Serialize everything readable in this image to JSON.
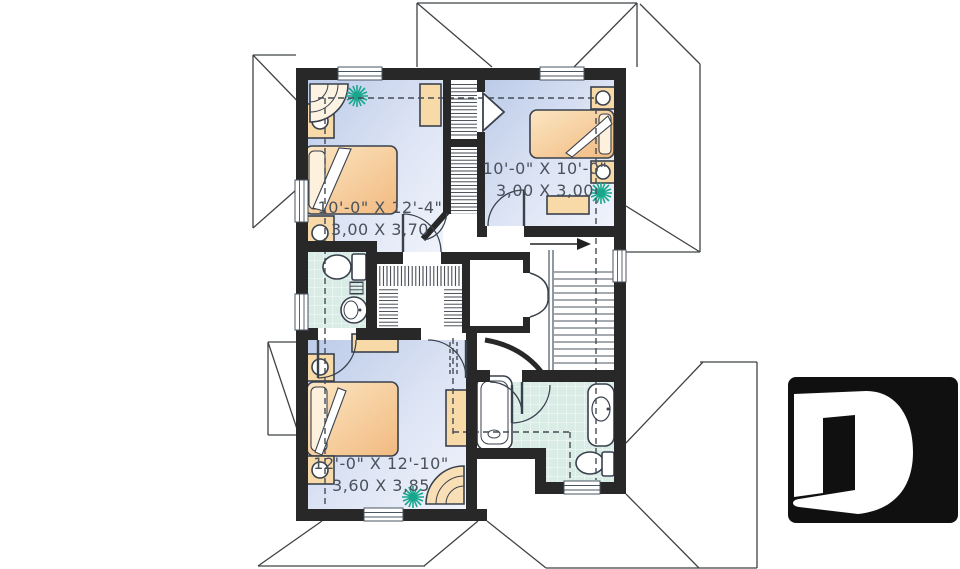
{
  "plan": {
    "type": "floor-plan",
    "rooms": [
      {
        "name": "bedroom-1",
        "imperial": "10'-0\" X 12'-4\"",
        "metric": "3,00 X 3,70"
      },
      {
        "name": "bedroom-2",
        "imperial": "10'-0\" X 10'-0\"",
        "metric": "3,00 X 3,00"
      },
      {
        "name": "bedroom-3",
        "imperial": "12'-0\" X 12'-10\"",
        "metric": "3,60 X 3,85"
      }
    ],
    "icons": {
      "logo": "letter-d-logo",
      "plant": "plant-icon",
      "stairs_arrow": "right-arrow-icon"
    },
    "logo_letter": "D",
    "colors": {
      "wall": "#282828",
      "floor": "#bccbe9",
      "floor_light": "#f0f3fb",
      "tile": "#d9ece6",
      "furniture": "#f5c792",
      "outline": "#39414d",
      "plant": "#17a78d",
      "label": "#49525b",
      "logo_bg": "#101010"
    }
  }
}
